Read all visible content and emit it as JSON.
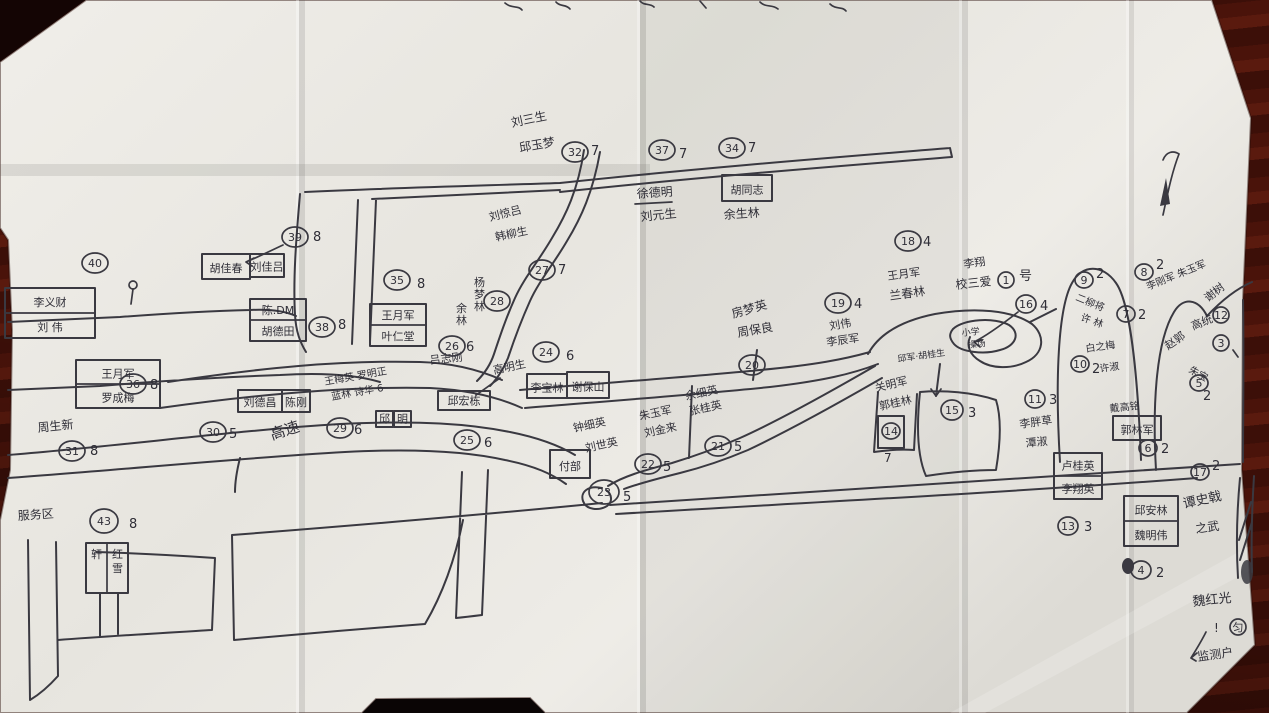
{
  "scene": {
    "kind": "photograph of a hand-drawn village sketch map on folded white paper, lying on a dark red-brown wooden desk",
    "paper_color": "#eceae4",
    "ink_color": "#3a3941",
    "wood_color": "#4a130a"
  },
  "map": {
    "road_label": "高速",
    "labels": [
      {
        "t": "刘三生",
        "x": 512,
        "y": 127,
        "r": -12
      },
      {
        "t": "邱玉梦",
        "x": 520,
        "y": 152,
        "r": -10
      },
      {
        "t": "刘惊吕",
        "x": 490,
        "y": 221,
        "r": -14,
        "s": 11
      },
      {
        "t": "韩柳生",
        "x": 496,
        "y": 241,
        "r": -12,
        "s": 11
      },
      {
        "t": "徐德明",
        "x": 637,
        "y": 198,
        "r": -4
      },
      {
        "t": "刘元生",
        "x": 641,
        "y": 221,
        "r": -6
      },
      {
        "t": "余生林",
        "x": 724,
        "y": 219,
        "r": -4
      },
      {
        "t": "周生新",
        "x": 38,
        "y": 432,
        "r": -6
      },
      {
        "t": "服务区",
        "x": 18,
        "y": 520,
        "r": -4
      },
      {
        "t": "高速",
        "x": 272,
        "y": 440,
        "r": -18,
        "s": 15
      },
      {
        "t": "王梅英 罗明正",
        "x": 325,
        "y": 385,
        "r": -10,
        "s": 10
      },
      {
        "t": "蓝林 诗华 6",
        "x": 332,
        "y": 400,
        "r": -10,
        "s": 10
      },
      {
        "t": "吕志刚",
        "x": 430,
        "y": 364,
        "r": -6,
        "s": 11
      },
      {
        "t": "高明生",
        "x": 494,
        "y": 374,
        "r": -12,
        "s": 11
      },
      {
        "t": "钟细英",
        "x": 574,
        "y": 432,
        "r": -12,
        "s": 11
      },
      {
        "t": "刘世英",
        "x": 586,
        "y": 452,
        "r": -12,
        "s": 11
      },
      {
        "t": "朱玉军",
        "x": 640,
        "y": 420,
        "r": -12,
        "s": 11
      },
      {
        "t": "刘金来",
        "x": 645,
        "y": 437,
        "r": -12,
        "s": 11
      },
      {
        "t": "余细英",
        "x": 686,
        "y": 400,
        "r": -12,
        "s": 11
      },
      {
        "t": "张桂英",
        "x": 690,
        "y": 415,
        "r": -12,
        "s": 11
      },
      {
        "t": "房梦英",
        "x": 733,
        "y": 318,
        "r": -16,
        "s": 12
      },
      {
        "t": "周保良",
        "x": 738,
        "y": 337,
        "r": -10,
        "s": 12
      },
      {
        "t": "刘伟",
        "x": 830,
        "y": 330,
        "r": -10,
        "s": 11
      },
      {
        "t": "李辰军",
        "x": 827,
        "y": 346,
        "r": -8,
        "s": 11
      },
      {
        "t": "王月军",
        "x": 888,
        "y": 280,
        "r": -8,
        "s": 11
      },
      {
        "t": "兰春林",
        "x": 890,
        "y": 300,
        "r": -8,
        "s": 12
      },
      {
        "t": "李翔",
        "x": 964,
        "y": 268,
        "r": -8,
        "s": 11
      },
      {
        "t": "校三爱",
        "x": 956,
        "y": 289,
        "r": -6,
        "s": 12
      },
      {
        "t": "邱军·胡桂生",
        "x": 898,
        "y": 362,
        "r": -8,
        "s": 9
      },
      {
        "t": "关明军",
        "x": 876,
        "y": 392,
        "r": -14,
        "s": 11
      },
      {
        "t": "郭桂林",
        "x": 880,
        "y": 410,
        "r": -12,
        "s": 11
      },
      {
        "t": "小学",
        "x": 962,
        "y": 336,
        "r": -6,
        "s": 9
      },
      {
        "t": "操场",
        "x": 968,
        "y": 348,
        "r": -6,
        "s": 9
      },
      {
        "t": "白之梅",
        "x": 1086,
        "y": 352,
        "r": -8,
        "s": 10
      },
      {
        "t": "许淑",
        "x": 1100,
        "y": 372,
        "r": -8,
        "s": 10
      },
      {
        "t": "二柳将",
        "x": 1075,
        "y": 300,
        "r": 22,
        "s": 10
      },
      {
        "t": "许 林",
        "x": 1080,
        "y": 320,
        "r": 20,
        "s": 10
      },
      {
        "t": "李刚军 朱玉军",
        "x": 1148,
        "y": 290,
        "r": -22,
        "s": 10
      },
      {
        "t": "谢树",
        "x": 1208,
        "y": 302,
        "r": -38,
        "s": 11
      },
      {
        "t": "高统",
        "x": 1193,
        "y": 330,
        "r": -22,
        "s": 11
      },
      {
        "t": "赵郭",
        "x": 1168,
        "y": 350,
        "r": -35,
        "s": 11
      },
      {
        "t": "朱宝",
        "x": 1188,
        "y": 372,
        "r": 28,
        "s": 10
      },
      {
        "t": "戴高铭",
        "x": 1110,
        "y": 412,
        "r": -6,
        "s": 10
      },
      {
        "t": "李胖草",
        "x": 1020,
        "y": 428,
        "r": -8,
        "s": 11
      },
      {
        "t": "潭淑",
        "x": 1026,
        "y": 447,
        "r": -6,
        "s": 11
      },
      {
        "t": "谭史戟",
        "x": 1184,
        "y": 508,
        "r": -12,
        "s": 13
      },
      {
        "t": "之武",
        "x": 1196,
        "y": 533,
        "r": -8,
        "s": 12
      },
      {
        "t": "魏红光",
        "x": 1193,
        "y": 606,
        "r": -6,
        "s": 13
      },
      {
        "t": "!",
        "x": 1214,
        "y": 632,
        "s": 12
      },
      {
        "t": "监测户",
        "x": 1198,
        "y": 661,
        "r": -8,
        "s": 12
      },
      {
        "t": "7",
        "x": 884,
        "y": 462,
        "s": 12
      }
    ],
    "vertical_labels": [
      {
        "t": "杨梦林",
        "x": 474,
        "y": 286,
        "s": 11
      },
      {
        "t": "余林",
        "x": 456,
        "y": 312,
        "s": 11
      }
    ],
    "circled_numbers": [
      {
        "n": "32",
        "x": 575,
        "y": 152,
        "sfx": "7",
        "dx": 16,
        "dy": 3
      },
      {
        "n": "37",
        "x": 662,
        "y": 150,
        "sfx": "7",
        "dx": 17,
        "dy": 8
      },
      {
        "n": "34",
        "x": 732,
        "y": 148,
        "sfx": "7",
        "dx": 16,
        "dy": 4
      },
      {
        "n": "39",
        "x": 295,
        "y": 237,
        "sfx": "8",
        "dx": 18,
        "dy": 4
      },
      {
        "n": "40",
        "x": 95,
        "y": 263
      },
      {
        "n": "38",
        "x": 322,
        "y": 327,
        "sfx": "8",
        "dx": 16,
        "dy": 2
      },
      {
        "n": "35",
        "x": 397,
        "y": 280,
        "sfx": "8",
        "dx": 20,
        "dy": 8
      },
      {
        "n": "36",
        "x": 133,
        "y": 384,
        "sfx": "8",
        "dx": 17,
        "dy": 5
      },
      {
        "n": "31",
        "x": 72,
        "y": 451,
        "sfx": "8",
        "dx": 18,
        "dy": 4
      },
      {
        "n": "30",
        "x": 213,
        "y": 432,
        "sfx": "5",
        "dx": 16,
        "dy": 6
      },
      {
        "n": "29",
        "x": 340,
        "y": 428,
        "sfx": "6",
        "dx": 14,
        "dy": 6
      },
      {
        "n": "26",
        "x": 452,
        "y": 346,
        "sfx": "6",
        "dx": 14,
        "dy": 5
      },
      {
        "n": "24",
        "x": 546,
        "y": 352,
        "sfx": "6",
        "dx": 20,
        "dy": 8
      },
      {
        "n": "25",
        "x": 467,
        "y": 440,
        "sfx": "6",
        "dx": 17,
        "dy": 7
      },
      {
        "n": "28",
        "x": 497,
        "y": 301
      },
      {
        "n": "27",
        "x": 542,
        "y": 270,
        "sfx": "7",
        "dx": 16,
        "dy": 4
      },
      {
        "n": "22",
        "x": 648,
        "y": 464,
        "sfx": "5",
        "dx": 15,
        "dy": 7
      },
      {
        "n": "23",
        "x": 604,
        "y": 492,
        "rx": 15,
        "ry": 12,
        "sfx": "5",
        "dx": 19,
        "dy": 9
      },
      {
        "n": "21",
        "x": 718,
        "y": 446,
        "sfx": "5",
        "dx": 16,
        "dy": 5
      },
      {
        "n": "20",
        "x": 752,
        "y": 365
      },
      {
        "n": "19",
        "x": 838,
        "y": 303,
        "sfx": "4",
        "dx": 16,
        "dy": 5
      },
      {
        "n": "18",
        "x": 908,
        "y": 241,
        "sfx": "4",
        "dx": 15,
        "dy": 5
      },
      {
        "n": "1",
        "x": 1006,
        "y": 280,
        "rx": 8,
        "ry": 8,
        "sfx": "号",
        "dx": 13,
        "dy": 0
      },
      {
        "n": "16",
        "x": 1026,
        "y": 304,
        "rx": 10,
        "ry": 9,
        "sfx": "4",
        "dx": 14,
        "dy": 6
      },
      {
        "n": "15",
        "x": 952,
        "y": 410,
        "rx": 11,
        "ry": 10,
        "sfx": "3",
        "dx": 16,
        "dy": 7
      },
      {
        "n": "14",
        "x": 891,
        "y": 431,
        "rx": 9,
        "ry": 8
      },
      {
        "n": "11",
        "x": 1035,
        "y": 399,
        "rx": 10,
        "ry": 9,
        "sfx": "3",
        "dx": 14,
        "dy": 5
      },
      {
        "n": "10",
        "x": 1080,
        "y": 364,
        "rx": 9,
        "ry": 8,
        "sfx": "2",
        "dx": 12,
        "dy": 9
      },
      {
        "n": "9",
        "x": 1084,
        "y": 280,
        "rx": 9,
        "ry": 8,
        "sfx": "2",
        "dx": 12,
        "dy": -2
      },
      {
        "n": "8",
        "x": 1144,
        "y": 272,
        "rx": 9,
        "ry": 8,
        "sfx": "2",
        "dx": 12,
        "dy": -3
      },
      {
        "n": "7",
        "x": 1126,
        "y": 314,
        "rx": 9,
        "ry": 8,
        "sfx": "2",
        "dx": 12,
        "dy": 5
      },
      {
        "n": "12",
        "x": 1221,
        "y": 315,
        "rx": 8,
        "ry": 8
      },
      {
        "n": "3",
        "x": 1221,
        "y": 343,
        "rx": 8,
        "ry": 8
      },
      {
        "n": "5",
        "x": 1199,
        "y": 383,
        "rx": 9,
        "ry": 8,
        "sfx": "2",
        "dx": 4,
        "dy": 17
      },
      {
        "n": "6",
        "x": 1148,
        "y": 448,
        "rx": 9,
        "ry": 8,
        "sfx": "2",
        "dx": 13,
        "dy": 5
      },
      {
        "n": "4",
        "x": 1141,
        "y": 570,
        "rx": 10,
        "ry": 9,
        "sfx": "2",
        "dx": 15,
        "dy": 7
      },
      {
        "n": "13",
        "x": 1068,
        "y": 526,
        "rx": 10,
        "ry": 9,
        "sfx": "3",
        "dx": 16,
        "dy": 5
      },
      {
        "n": "17",
        "x": 1200,
        "y": 472,
        "rx": 9,
        "ry": 8,
        "sfx": "2",
        "dx": 12,
        "dy": -2
      },
      {
        "n": "43",
        "x": 104,
        "y": 521,
        "rx": 14,
        "ry": 12,
        "sfx": "8",
        "dx": 25,
        "dy": 7
      },
      {
        "n": "匀",
        "x": 1238,
        "y": 627,
        "rx": 8,
        "ry": 8
      }
    ],
    "house_boxes": [
      {
        "x": 5,
        "y": 288,
        "w": 90,
        "h": 50,
        "rows": [
          "李义财",
          "刘 伟"
        ]
      },
      {
        "x": 76,
        "y": 360,
        "w": 84,
        "h": 48,
        "rows": [
          "王月军",
          "罗成梅"
        ]
      },
      {
        "x": 202,
        "y": 254,
        "w": 48,
        "h": 25,
        "rows": [
          "胡佳春"
        ]
      },
      {
        "x": 250,
        "y": 254,
        "w": 34,
        "h": 23,
        "rows": [
          "刘佳吕"
        ]
      },
      {
        "x": 250,
        "y": 299,
        "w": 56,
        "h": 42,
        "rows": [
          "陈.DM",
          "胡德田"
        ]
      },
      {
        "x": 370,
        "y": 304,
        "w": 56,
        "h": 42,
        "rows": [
          "王月军",
          "叶仁堂"
        ]
      },
      {
        "x": 238,
        "y": 390,
        "w": 44,
        "h": 22,
        "rows": [
          "刘德昌"
        ]
      },
      {
        "x": 282,
        "y": 390,
        "w": 28,
        "h": 22,
        "rows": [
          "陈刚"
        ]
      },
      {
        "x": 527,
        "y": 374,
        "w": 40,
        "h": 24,
        "rows": [
          "李宝林"
        ]
      },
      {
        "x": 567,
        "y": 372,
        "w": 42,
        "h": 26,
        "rows": [
          "谢保山"
        ]
      },
      {
        "x": 438,
        "y": 391,
        "w": 52,
        "h": 19,
        "rows": [
          "邱宏栋"
        ]
      },
      {
        "x": 376,
        "y": 411,
        "w": 17,
        "h": 16,
        "rows": [
          "邱"
        ]
      },
      {
        "x": 394,
        "y": 411,
        "w": 17,
        "h": 16,
        "rows": [
          "明"
        ]
      },
      {
        "x": 722,
        "y": 175,
        "w": 50,
        "h": 26,
        "rows": [
          "胡同志"
        ]
      },
      {
        "x": 550,
        "y": 450,
        "w": 40,
        "h": 28,
        "rows": [
          "付部"
        ]
      },
      {
        "x": 1113,
        "y": 416,
        "w": 48,
        "h": 24,
        "rows": [
          "郭林军"
        ]
      },
      {
        "x": 1054,
        "y": 453,
        "w": 48,
        "h": 46,
        "rows": [
          "卢桂英",
          "李翔英"
        ]
      },
      {
        "x": 1124,
        "y": 496,
        "w": 54,
        "h": 50,
        "rows": [
          "邱安林",
          "魏明伟"
        ]
      },
      {
        "x": 86,
        "y": 543,
        "w": 42,
        "h": 50,
        "rows": [
          "轩",
          "红雪"
        ],
        "vert": true
      },
      {
        "x": 878,
        "y": 416,
        "w": 26,
        "h": 32,
        "rows": [
          ""
        ]
      }
    ]
  }
}
